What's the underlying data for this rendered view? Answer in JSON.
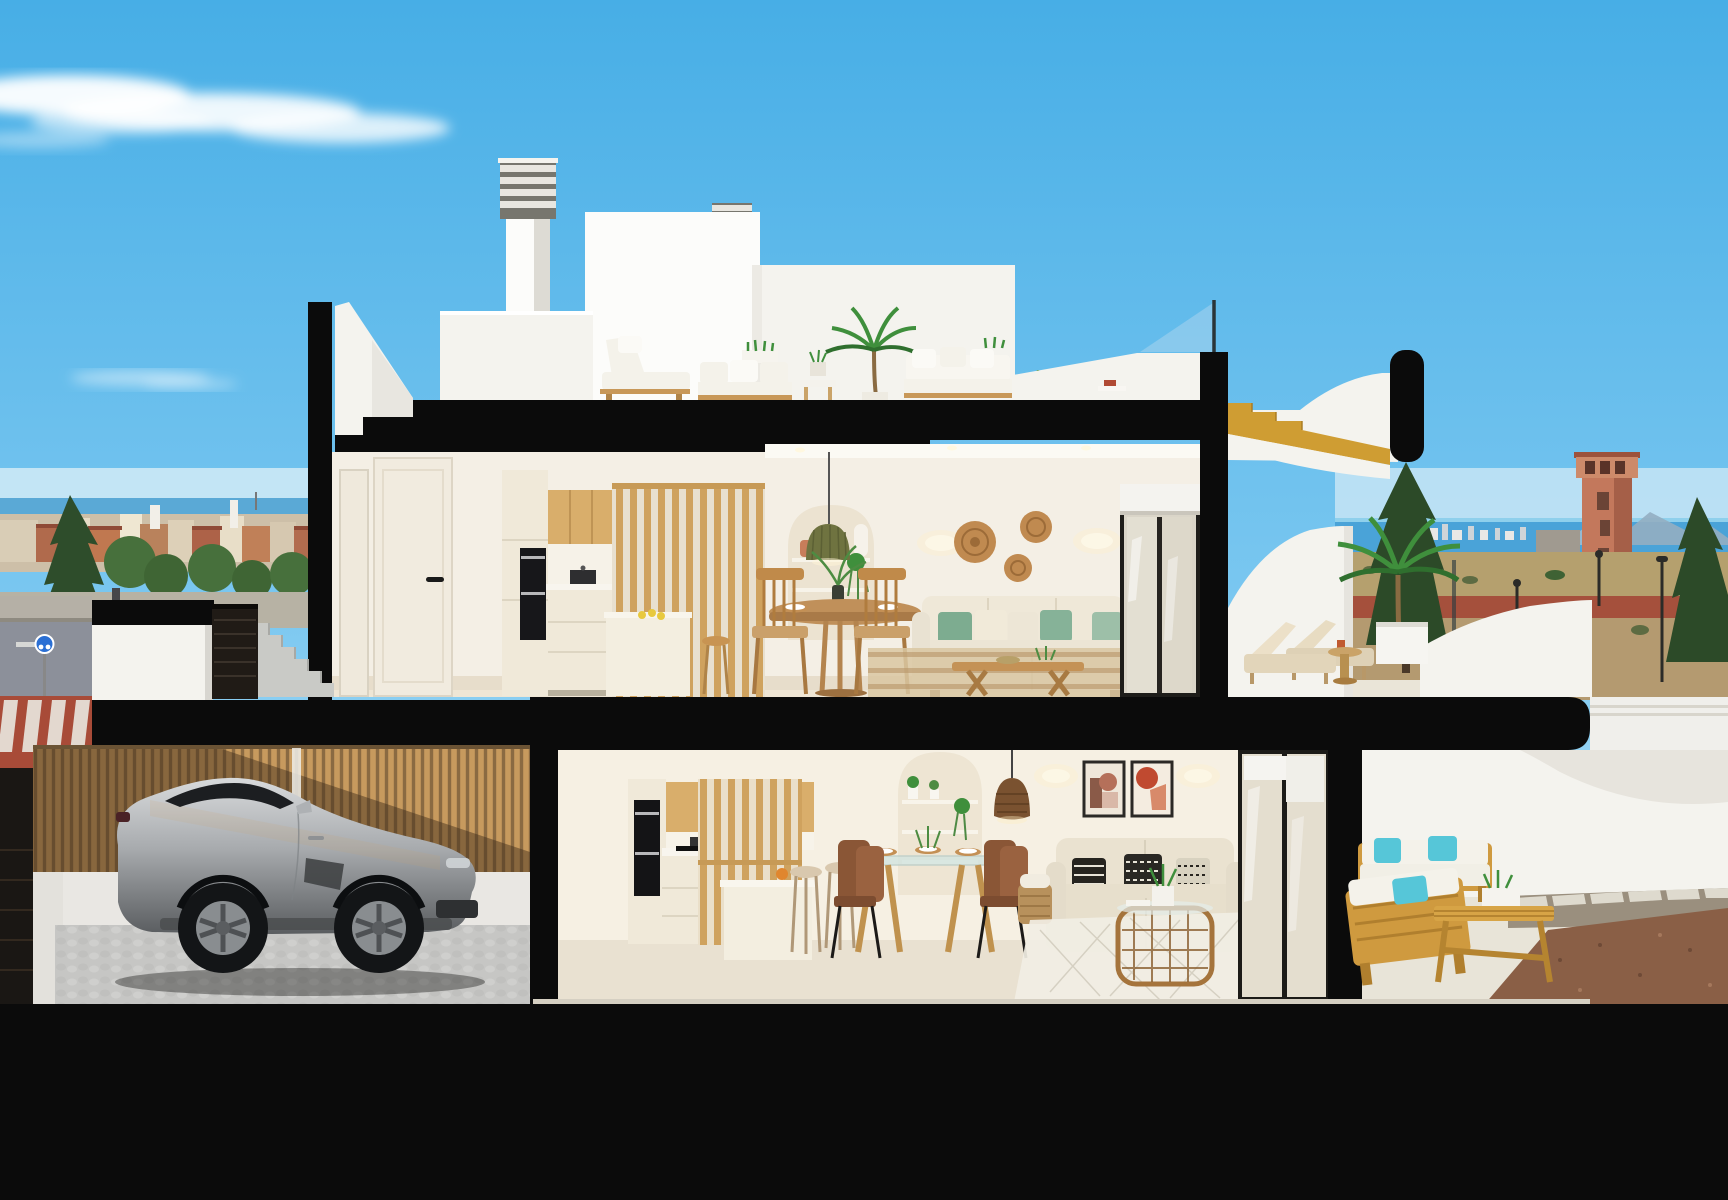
{
  "meta": {
    "title": "Cutaway cross-section render of a three-level coastal townhouse with roof terrace, furnished interiors, carport with silver sports coupe, and rear patio",
    "render_type": "architectural 3d visualization",
    "width_px": 1728,
    "height_px": 1200
  },
  "colors": {
    "sky_top": "#47aee6",
    "sky_mid": "#7ac7f0",
    "sky_low": "#a3d9f5",
    "sky_horizon": "#c9eafa",
    "cloud_white": "#ffffff",
    "sea_blue": "#4aa3d8",
    "sea_light": "#8fd0ec",
    "mountain_haze": "#93aec2",
    "town_wall": "#cdbfa8",
    "town_roof": "#b06a4c",
    "tree_dark": "#2e4d2b",
    "tree_mid": "#47703c",
    "field_tan": "#b5a06e",
    "red_lot": "#a5503c",
    "asphalt": "#8c909a",
    "sidewalk": "#b5b0a6",
    "crosswalk_red": "#a84b38",
    "crosswalk_stripe": "#e8e4dc",
    "sign_blue": "#2a6fd4",
    "tower_terracotta": "#c3785c",
    "cut_black": "#0b0b0b",
    "wall_bright": "#fcfcfa",
    "wall_white": "#f4f3ee",
    "wall_shade": "#e7e5de",
    "interior_wall": "#f4efe5",
    "interior_wall_lower": "#f6f0e3",
    "cabinet_cream": "#f0e9d9",
    "wood_cabinet": "#d9ae6b",
    "wood_slat": "#cfa25e",
    "wood_gold": "#cf9d33",
    "wood_outdoor": "#cf9a3f",
    "wood_table": "#c0905a",
    "oven_black": "#17171a",
    "floor_tile": "#e7ddcb",
    "sofa_cream": "#ece5d5",
    "pillow_green": "#7dac90",
    "pillow_sage": "#9dbfa8",
    "pillow_turquoise": "#56c6d8",
    "cushion_white": "#f4f2ea",
    "rattan": "#c08a50",
    "pendant_olive": "#6f7340",
    "glass_frame": "#1c1b18",
    "glass_pane": "#e0dccd",
    "glass_balustrade": "#a8d4ee",
    "blind_white": "#f5f4f0",
    "fence_wood": "#c79a5e",
    "fence_gap": "#8a6a42",
    "gate_dark": "#201b16",
    "step_concrete": "#c9cac6",
    "cobble_gray": "#c6c6c4",
    "car_silver_hi": "#d8dadc",
    "car_silver_mid": "#a8abae",
    "car_silver_low": "#5a5d60",
    "car_glass": "#1c1e21",
    "tyre_black": "#131517",
    "rim_silver": "#898d90",
    "rug_stripe": "#b89468",
    "rug_cream": "#f1eee4",
    "gravel_brown": "#8a5f46",
    "paver_light": "#dedace",
    "plant_green": "#3f8f3c",
    "plant_dark": "#2f6f2e",
    "lounger_beige": "#e2d5ba",
    "art_terracotta": "#c04a30"
  },
  "scene": {
    "environment": {
      "sky": "clear blue sky with one wispy cloud streak upper-left",
      "left_background": "low-rise town with terracotta roofs, conifer and broadleaf trees, thin sea line",
      "right_background": "sea horizon with distant skyline, hazy mountains, terracotta watchtower, arid field, red parking lot, street lamps, conifer trees",
      "street": "road at lower left with gray asphalt, red crosswalk band, white stripes, blue round sign, utility pole"
    },
    "building": {
      "type": "sectional cut — all cut walls and slabs rendered solid black",
      "roof_terrace": [
        "two louvered chimneys",
        "white penthouse volumes",
        "white slanted stair bulkhead",
        "glass balustrade with mast",
        "white outdoor lounge chair",
        "two white outdoor sofas",
        "potted palm",
        "side table with plant",
        "golden timber stair flight descending to terrace",
        "black rounded parapet cap"
      ],
      "upper_floor": {
        "hall": [
          "two cream doors",
          "black lever handle"
        ],
        "kitchen": [
          "tall cream units",
          "black built-in double oven",
          "oak upper cabinets",
          "pot on hob",
          "cream base cabinets",
          "timber slat partition",
          "island with lemons",
          "timber bar stool"
        ],
        "dining": [
          "arched shelving niche with vases and trailing plant",
          "olive pleated pendant lamp",
          "round timber dining table with plates and centerpiece plant",
          "two timber chairs"
        ],
        "living": [
          "two wall sconces",
          "three rattan wall discs",
          "cream L-sofa with green and cream pillows",
          "timber coffee table",
          "striped beige rug",
          "black-framed sliding glass door with roller blind"
        ],
        "terrace": [
          "white curved parapet",
          "two beige sun loungers",
          "timber side table",
          "palm in white planter",
          "glass edge screen",
          "white curved neighbour wall"
        ]
      },
      "ground_floor": {
        "entry": [
          "black slab band",
          "white stair wall",
          "dark slatted gate",
          "concrete steps"
        ],
        "carport": [
          "timber slat fence with diagonal shadow",
          "white base wall",
          "cobblestone paving",
          "silver sports coupe facing right",
          "dark louvered side door"
        ],
        "kitchen": [
          "black built-in oven",
          "oak upper cabinets",
          "induction hob with pot",
          "coffee machine",
          "timber slat partition",
          "cream island with orange fruit",
          "two beige bar stools"
        ],
        "dining": [
          "glass-top table on timber legs with place settings",
          "four brown leather chairs",
          "arched shelving niche with plants",
          "rattan pendant lamp"
        ],
        "living": [
          "two framed abstract prints",
          "two wall sconces",
          "beige loveseat with three patterned monochrome pillows",
          "woven basket with throw",
          "rattan coffee table with potted plant",
          "white diamond rug",
          "black-framed sliding glass doors with blinds"
        ],
        "patio": [
          "two golden timber sofas with white cushions and turquoise pillows",
          "timber bench table with planter",
          "white curved walls",
          "stepping-stone path",
          "brown gravel bed",
          "cream paving"
        ]
      }
    }
  }
}
